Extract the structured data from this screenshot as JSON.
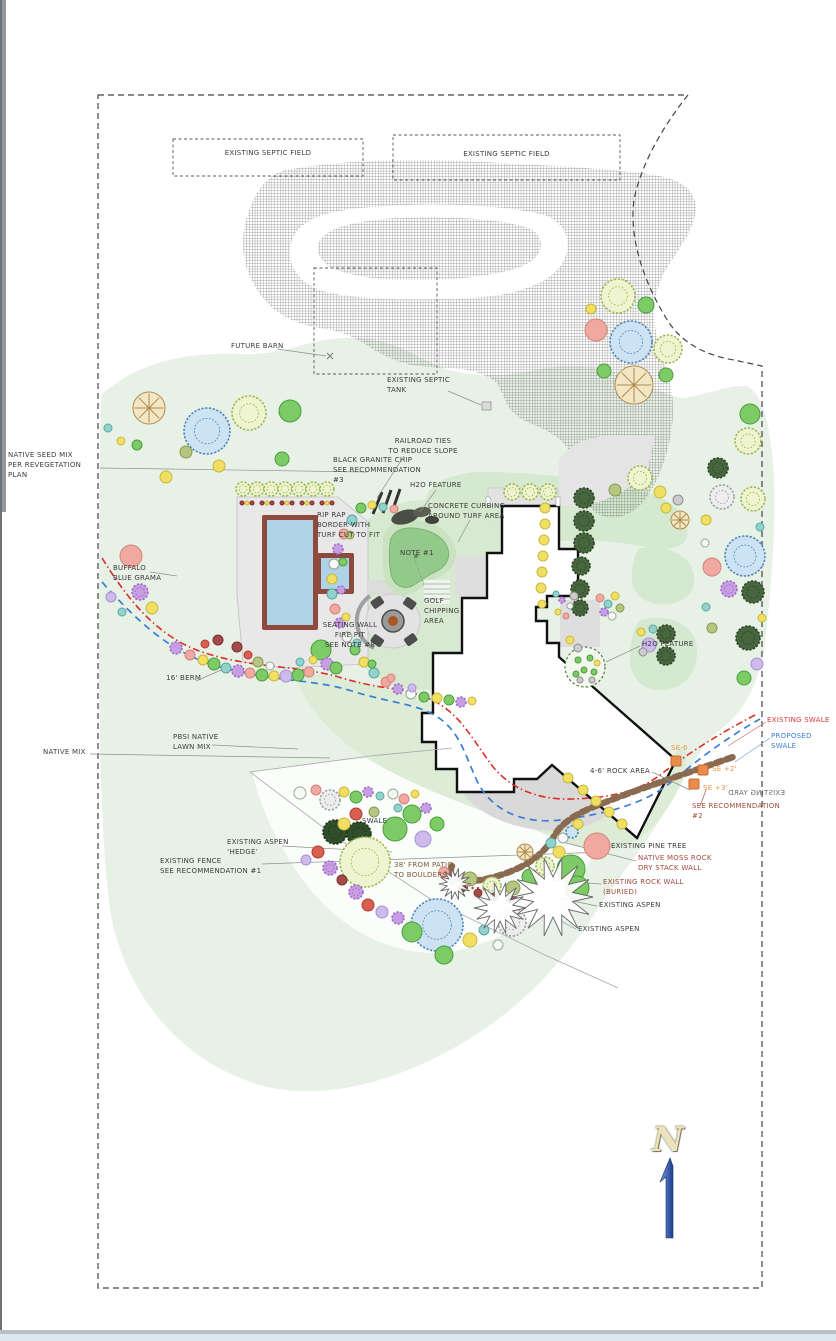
{
  "north": {
    "letter": "N"
  },
  "labels": [
    {
      "name": "septic-field-label-1",
      "text": "EXISTING SEPTIC FIELD",
      "x": 173,
      "y": 149,
      "w": 190,
      "align": "center"
    },
    {
      "name": "septic-field-label-2",
      "text": "EXISTING SEPTIC FIELD",
      "x": 393,
      "y": 150,
      "w": 227,
      "align": "center"
    },
    {
      "name": "future-barn-label",
      "text": "FUTURE BARN",
      "x": 231,
      "y": 342
    },
    {
      "name": "existing-septic-tank-label",
      "text": "EXISTING SEPTIC\nTANK",
      "x": 387,
      "y": 376
    },
    {
      "name": "native-seed-mix-label",
      "text": "NATIVE SEED MIX\nPER REVEGETATION\nPLAN",
      "x": 8,
      "y": 451
    },
    {
      "name": "railroad-ties-label",
      "text": "RAILROAD TIES\nTO REDUCE SLOPE",
      "x": 378,
      "y": 437,
      "w": 90,
      "align": "center"
    },
    {
      "name": "black-granite-chip-label",
      "text": "BLACK GRANITE CHIP\nSEE RECOMMENDATION\n#3",
      "x": 333,
      "y": 456
    },
    {
      "name": "h2o-feature-label-1",
      "text": "H2O FEATURE",
      "x": 410,
      "y": 481
    },
    {
      "name": "concrete-curbing-label",
      "text": "CONCRETE CURBING\nAROUND TURF AREA",
      "x": 428,
      "y": 502
    },
    {
      "name": "rip-rap-border-label",
      "text": "RIP RAP\nBORDER WITH\nTURF CUT TO FIT",
      "x": 317,
      "y": 511
    },
    {
      "name": "note-1-label",
      "text": "NOTE #1",
      "x": 400,
      "y": 549
    },
    {
      "name": "golf-chipping-area-label",
      "text": "GOLF\nCHIPPING\nAREA",
      "x": 424,
      "y": 597
    },
    {
      "name": "seating-wall-fire-pit-label",
      "text": "SEATING WALL\nFIRE PIT\nSEE NOTE #8",
      "x": 308,
      "y": 621,
      "w": 84,
      "align": "center"
    },
    {
      "name": "h2o-feature-label-2",
      "text": "H2O FEATURE",
      "x": 642,
      "y": 640
    },
    {
      "name": "berm-label",
      "text": "16' BERM",
      "x": 166,
      "y": 674
    },
    {
      "name": "pbsi-native-lawn-label",
      "text": "PBSI NATIVE\nLAWN MIX",
      "x": 173,
      "y": 733
    },
    {
      "name": "native-mix-label",
      "text": "NATIVE MIX",
      "x": 43,
      "y": 748
    },
    {
      "name": "existing-swale-label",
      "text": "EXISTING SWALE",
      "x": 767,
      "y": 716,
      "color": "#e03535"
    },
    {
      "name": "proposed-swale-label",
      "text": "PROPOSED SWALE",
      "x": 771,
      "y": 732,
      "color": "#3d7fd6"
    },
    {
      "name": "se-0-label",
      "text": "SE-0",
      "x": 671,
      "y": 744,
      "color": "#e8923f"
    },
    {
      "name": "rock-area-label",
      "text": "4-6' ROCK AREA",
      "x": 590,
      "y": 767
    },
    {
      "name": "se-plus-2-label",
      "text": "SE +2'",
      "x": 712,
      "y": 765,
      "color": "#e8923f"
    },
    {
      "name": "se-plus-3-label",
      "text": "SE +3'",
      "x": 703,
      "y": 784,
      "color": "#e8923f"
    },
    {
      "name": "existing-yard-label",
      "text": "EXISTING YARD",
      "x": 728,
      "y": 789,
      "color": "#6a6a6a",
      "mirrored": true
    },
    {
      "name": "see-recommendation-2-label",
      "text": "SEE RECOMMENDATION\n#2",
      "x": 692,
      "y": 802,
      "color": "#a14a3a"
    },
    {
      "name": "swale-label",
      "text": "SWALE",
      "x": 362,
      "y": 817
    },
    {
      "name": "existing-aspen-hedge-label",
      "text": "EXISTING ASPEN\n‘HEDGE’",
      "x": 227,
      "y": 838
    },
    {
      "name": "existing-fence-label",
      "text": "EXISTING FENCE\nSEE RECOMMENDATION #1",
      "x": 160,
      "y": 857
    },
    {
      "name": "patio-distance-label",
      "text": "38' FROM PATIO\nTO BOULDERS",
      "x": 394,
      "y": 861,
      "color": "#7a5a3d"
    },
    {
      "name": "existing-pine-tree-label",
      "text": "EXISTING PINE TREE",
      "x": 611,
      "y": 842
    },
    {
      "name": "moss-rock-wall-label",
      "text": "NATIVE MOSS ROCK\nDRY STACK WALL",
      "x": 638,
      "y": 854,
      "color": "#a14a3a"
    },
    {
      "name": "existing-rock-wall-label",
      "text": "EXISTING ROCK WALL\n(BURIED)",
      "x": 603,
      "y": 878,
      "color": "#a14a3a"
    },
    {
      "name": "existing-aspen-label-1",
      "text": "EXISTING ASPEN",
      "x": 599,
      "y": 901
    },
    {
      "name": "existing-aspen-label-2",
      "text": "EXISTING ASPEN",
      "x": 578,
      "y": 925
    },
    {
      "name": "buffalo-blue-grama-label",
      "text": "BUFFALO\nBLUE GRAMA",
      "x": 113,
      "y": 564
    }
  ],
  "plants": [
    [
      "sketch-lime",
      243,
      489,
      7
    ],
    [
      "sketch-lime",
      257,
      489,
      7
    ],
    [
      "sketch-lime",
      271,
      489,
      7
    ],
    [
      "sketch-lime",
      285,
      489,
      7
    ],
    [
      "sketch-lime",
      299,
      489,
      7
    ],
    [
      "sketch-lime",
      313,
      489,
      7
    ],
    [
      "sketch-lime",
      327,
      489,
      7
    ],
    [
      "maroon",
      242,
      503,
      2
    ],
    [
      "yellow",
      247,
      503,
      2
    ],
    [
      "maroon",
      252,
      503,
      2
    ],
    [
      "yellow",
      267,
      503,
      2
    ],
    [
      "maroon",
      262,
      503,
      2
    ],
    [
      "maroon",
      272,
      503,
      2
    ],
    [
      "yellow",
      287,
      503,
      2
    ],
    [
      "maroon",
      282,
      503,
      2
    ],
    [
      "maroon",
      292,
      503,
      2
    ],
    [
      "yellow",
      307,
      503,
      2
    ],
    [
      "maroon",
      302,
      503,
      2
    ],
    [
      "maroon",
      312,
      503,
      2
    ],
    [
      "yellow",
      327,
      503,
      2
    ],
    [
      "maroon",
      322,
      503,
      2
    ],
    [
      "maroon",
      332,
      503,
      2
    ],
    [
      "sketch-lime",
      618,
      296,
      17
    ],
    [
      "green",
      646,
      305,
      8
    ],
    [
      "sketch-blue",
      631,
      342,
      21
    ],
    [
      "sketch-lime",
      668,
      349,
      14
    ],
    [
      "pink",
      596,
      330,
      11
    ],
    [
      "star-tan",
      634,
      385,
      19
    ],
    [
      "green",
      604,
      371,
      7
    ],
    [
      "green",
      666,
      375,
      7
    ],
    [
      "yellow",
      591,
      309,
      5
    ],
    [
      "star-tan",
      149,
      408,
      16
    ],
    [
      "sketch-blue",
      207,
      431,
      23
    ],
    [
      "sketch-lime",
      249,
      413,
      17
    ],
    [
      "green",
      290,
      411,
      11
    ],
    [
      "teal",
      108,
      428,
      4
    ],
    [
      "yellow",
      121,
      441,
      4
    ],
    [
      "green",
      137,
      445,
      5
    ],
    [
      "yellow",
      166,
      477,
      6
    ],
    [
      "yellow",
      219,
      466,
      6
    ],
    [
      "olive",
      186,
      452,
      6
    ],
    [
      "green",
      282,
      459,
      7
    ],
    [
      "pink",
      131,
      556,
      11
    ],
    [
      "purple",
      140,
      592,
      8
    ],
    [
      "yellow",
      152,
      608,
      6
    ],
    [
      "teal",
      122,
      612,
      4
    ],
    [
      "lavender",
      111,
      597,
      5
    ],
    [
      "purple",
      176,
      648,
      6
    ],
    [
      "pink",
      190,
      655,
      5
    ],
    [
      "yellow",
      203,
      660,
      5
    ],
    [
      "green",
      214,
      664,
      6
    ],
    [
      "teal",
      226,
      668,
      5
    ],
    [
      "purple",
      238,
      671,
      6
    ],
    [
      "pink",
      250,
      673,
      5
    ],
    [
      "green",
      262,
      675,
      6
    ],
    [
      "yellow",
      274,
      676,
      5
    ],
    [
      "lavender",
      286,
      676,
      6
    ],
    [
      "green",
      298,
      675,
      6
    ],
    [
      "pink",
      309,
      672,
      5
    ],
    [
      "green",
      321,
      650,
      10
    ],
    [
      "maroon",
      218,
      640,
      5
    ],
    [
      "maroon",
      237,
      647,
      5
    ],
    [
      "red",
      205,
      644,
      4
    ],
    [
      "olive",
      258,
      662,
      5
    ],
    [
      "teal",
      300,
      662,
      4
    ],
    [
      "yellow",
      313,
      660,
      4
    ],
    [
      "purple",
      327,
      664,
      6
    ],
    [
      "green",
      336,
      668,
      6
    ],
    [
      "red",
      248,
      655,
      4
    ],
    [
      "white",
      270,
      666,
      4
    ],
    [
      "teal",
      352,
      520,
      5
    ],
    [
      "pink",
      344,
      534,
      5
    ],
    [
      "purple",
      338,
      549,
      5
    ],
    [
      "white",
      334,
      564,
      5
    ],
    [
      "yellow",
      332,
      579,
      5
    ],
    [
      "teal",
      332,
      594,
      5
    ],
    [
      "pink",
      335,
      609,
      5
    ],
    [
      "purple",
      340,
      623,
      5
    ],
    [
      "white",
      347,
      637,
      5
    ],
    [
      "green",
      355,
      650,
      5
    ],
    [
      "yellow",
      364,
      662,
      5
    ],
    [
      "teal",
      374,
      673,
      5
    ],
    [
      "pink",
      386,
      682,
      5
    ],
    [
      "purple",
      398,
      689,
      5
    ],
    [
      "white",
      411,
      694,
      5
    ],
    [
      "green",
      424,
      697,
      5
    ],
    [
      "yellow",
      437,
      698,
      5
    ],
    [
      "olive",
      350,
      535,
      4
    ],
    [
      "green",
      343,
      562,
      4
    ],
    [
      "purple",
      341,
      590,
      4
    ],
    [
      "yellow",
      346,
      617,
      4
    ],
    [
      "teal",
      357,
      643,
      4
    ],
    [
      "green",
      372,
      664,
      4
    ],
    [
      "pink",
      391,
      678,
      4
    ],
    [
      "lavender",
      412,
      688,
      4
    ],
    [
      "green",
      361,
      508,
      5
    ],
    [
      "yellow",
      372,
      505,
      4
    ],
    [
      "teal",
      383,
      507,
      4
    ],
    [
      "pink",
      394,
      509,
      4
    ],
    [
      "green",
      449,
      700,
      5
    ],
    [
      "purple",
      461,
      702,
      5
    ],
    [
      "yellow",
      472,
      701,
      4
    ],
    [
      "sketch-lime",
      512,
      492,
      8
    ],
    [
      "sketch-lime",
      530,
      492,
      8
    ],
    [
      "sketch-lime",
      548,
      492,
      8
    ],
    [
      "pine",
      584,
      498,
      10
    ],
    [
      "pine",
      584,
      521,
      10
    ],
    [
      "pine",
      584,
      543,
      10
    ],
    [
      "pine",
      581,
      566,
      9
    ],
    [
      "pine",
      580,
      589,
      9
    ],
    [
      "pine",
      580,
      608,
      8
    ],
    [
      "yellow",
      545,
      508,
      5
    ],
    [
      "yellow",
      545,
      524,
      5
    ],
    [
      "yellow",
      544,
      540,
      5
    ],
    [
      "yellow",
      543,
      556,
      5
    ],
    [
      "yellow",
      542,
      572,
      5
    ],
    [
      "yellow",
      541,
      588,
      5
    ],
    [
      "yellow",
      542,
      604,
      4
    ],
    [
      "teal",
      556,
      594,
      3
    ],
    [
      "purple",
      562,
      600,
      3
    ],
    [
      "white",
      570,
      606,
      3
    ],
    [
      "yellow",
      558,
      612,
      3
    ],
    [
      "pink",
      566,
      616,
      3
    ],
    [
      "grey",
      574,
      596,
      4
    ],
    [
      "sketch-lime",
      640,
      478,
      12
    ],
    [
      "yellow",
      660,
      492,
      6
    ],
    [
      "yellow",
      666,
      508,
      5
    ],
    [
      "grey",
      678,
      500,
      5
    ],
    [
      "star-tan",
      680,
      520,
      9
    ],
    [
      "olive",
      615,
      490,
      6
    ],
    [
      "pink",
      600,
      598,
      4
    ],
    [
      "teal",
      608,
      604,
      4
    ],
    [
      "yellow",
      615,
      596,
      4
    ],
    [
      "purple",
      604,
      612,
      4
    ],
    [
      "white",
      612,
      616,
      4
    ],
    [
      "olive",
      620,
      608,
      4
    ],
    [
      "yellow",
      570,
      640,
      4
    ],
    [
      "grey",
      578,
      648,
      4
    ],
    [
      "green",
      750,
      414,
      10
    ],
    [
      "sketch-lime",
      748,
      441,
      13
    ],
    [
      "pine",
      718,
      468,
      10
    ],
    [
      "greysketch",
      722,
      497,
      12
    ],
    [
      "sketch-lime",
      753,
      499,
      12
    ],
    [
      "sketch-blue",
      745,
      556,
      20
    ],
    [
      "pink",
      712,
      567,
      9
    ],
    [
      "purple",
      729,
      589,
      8
    ],
    [
      "pine",
      753,
      592,
      11
    ],
    [
      "pine",
      748,
      638,
      12
    ],
    [
      "yellow",
      706,
      520,
      5
    ],
    [
      "teal",
      760,
      527,
      4
    ],
    [
      "white",
      705,
      543,
      4
    ],
    [
      "yellow",
      762,
      618,
      4
    ],
    [
      "teal",
      706,
      607,
      4
    ],
    [
      "lavender",
      757,
      664,
      6
    ],
    [
      "green",
      744,
      678,
      7
    ],
    [
      "olive",
      712,
      628,
      5
    ],
    [
      "pine",
      666,
      634,
      9
    ],
    [
      "pine",
      666,
      656,
      9
    ],
    [
      "lavender",
      649,
      645,
      7
    ],
    [
      "yellow",
      641,
      632,
      4
    ],
    [
      "teal",
      653,
      629,
      4
    ],
    [
      "grey",
      643,
      652,
      4
    ],
    [
      "green",
      578,
      660,
      3
    ],
    [
      "green",
      590,
      658,
      3
    ],
    [
      "green",
      584,
      670,
      3
    ],
    [
      "green",
      594,
      672,
      3
    ],
    [
      "green",
      576,
      674,
      3
    ],
    [
      "yellow",
      597,
      663,
      3
    ],
    [
      "grey",
      580,
      680,
      3
    ],
    [
      "grey",
      592,
      680,
      3
    ],
    [
      "yellow",
      568,
      778,
      5
    ],
    [
      "yellow",
      583,
      790,
      5
    ],
    [
      "yellow",
      596,
      801,
      5
    ],
    [
      "yellow",
      609,
      812,
      5
    ],
    [
      "yellow",
      622,
      824,
      5
    ],
    [
      "darkpine",
      335,
      832,
      12
    ],
    [
      "darkpine",
      359,
      834,
      12
    ],
    [
      "green",
      395,
      829,
      12
    ],
    [
      "lavender",
      423,
      839,
      8
    ],
    [
      "green",
      437,
      824,
      7
    ],
    [
      "sketch-lime",
      365,
      862,
      25
    ],
    [
      "sketch-blue",
      437,
      925,
      26
    ],
    [
      "green",
      571,
      869,
      14
    ],
    [
      "green",
      577,
      888,
      12
    ],
    [
      "pink",
      597,
      846,
      13
    ],
    [
      "olive",
      470,
      879,
      7
    ],
    [
      "sketch-lime",
      492,
      886,
      9
    ],
    [
      "olive",
      513,
      888,
      7
    ],
    [
      "green",
      530,
      877,
      8
    ],
    [
      "sketch-lime",
      545,
      866,
      9
    ],
    [
      "yellow",
      559,
      852,
      6
    ],
    [
      "teal",
      551,
      843,
      5
    ],
    [
      "white",
      563,
      838,
      5
    ],
    [
      "sketch-blue",
      572,
      832,
      6
    ],
    [
      "maroon",
      462,
      888,
      4
    ],
    [
      "maroon",
      478,
      893,
      4
    ],
    [
      "maroon",
      494,
      897,
      4
    ],
    [
      "maroon",
      510,
      899,
      4
    ],
    [
      "teal",
      452,
      880,
      4
    ],
    [
      "pink",
      444,
      872,
      5
    ],
    [
      "white",
      300,
      793,
      6
    ],
    [
      "greysketch",
      330,
      800,
      10
    ],
    [
      "pink",
      316,
      790,
      5
    ],
    [
      "yellow",
      344,
      792,
      5
    ],
    [
      "green",
      356,
      797,
      6
    ],
    [
      "purple",
      368,
      792,
      5
    ],
    [
      "teal",
      380,
      796,
      4
    ],
    [
      "white",
      393,
      794,
      5
    ],
    [
      "pink",
      404,
      799,
      5
    ],
    [
      "yellow",
      415,
      794,
      4
    ],
    [
      "red",
      356,
      814,
      6
    ],
    [
      "yellow",
      344,
      824,
      6
    ],
    [
      "olive",
      374,
      812,
      5
    ],
    [
      "green",
      412,
      814,
      9
    ],
    [
      "teal",
      398,
      808,
      4
    ],
    [
      "purple",
      426,
      808,
      5
    ],
    [
      "purple",
      330,
      868,
      7
    ],
    [
      "red",
      318,
      852,
      6
    ],
    [
      "lavender",
      306,
      860,
      5
    ],
    [
      "maroon",
      342,
      880,
      5
    ],
    [
      "purple",
      356,
      892,
      7
    ],
    [
      "red",
      368,
      905,
      6
    ],
    [
      "lavender",
      382,
      912,
      6
    ],
    [
      "purple",
      398,
      918,
      6
    ],
    [
      "green",
      412,
      932,
      10
    ],
    [
      "green",
      444,
      955,
      9
    ],
    [
      "yellow",
      470,
      940,
      7
    ],
    [
      "teal",
      484,
      930,
      5
    ],
    [
      "greysketch",
      512,
      922,
      14
    ],
    [
      "white",
      498,
      945,
      5
    ],
    [
      "yellow",
      578,
      824,
      5
    ],
    [
      "star-tan",
      525,
      852,
      8
    ],
    [
      "aspen",
      553,
      897,
      40
    ],
    [
      "aspen",
      500,
      908,
      26
    ],
    [
      "aspen",
      455,
      884,
      16
    ],
    [
      "orange",
      676,
      761,
      5
    ],
    [
      "orange",
      703,
      770,
      5
    ],
    [
      "orange",
      694,
      784,
      5
    ]
  ]
}
